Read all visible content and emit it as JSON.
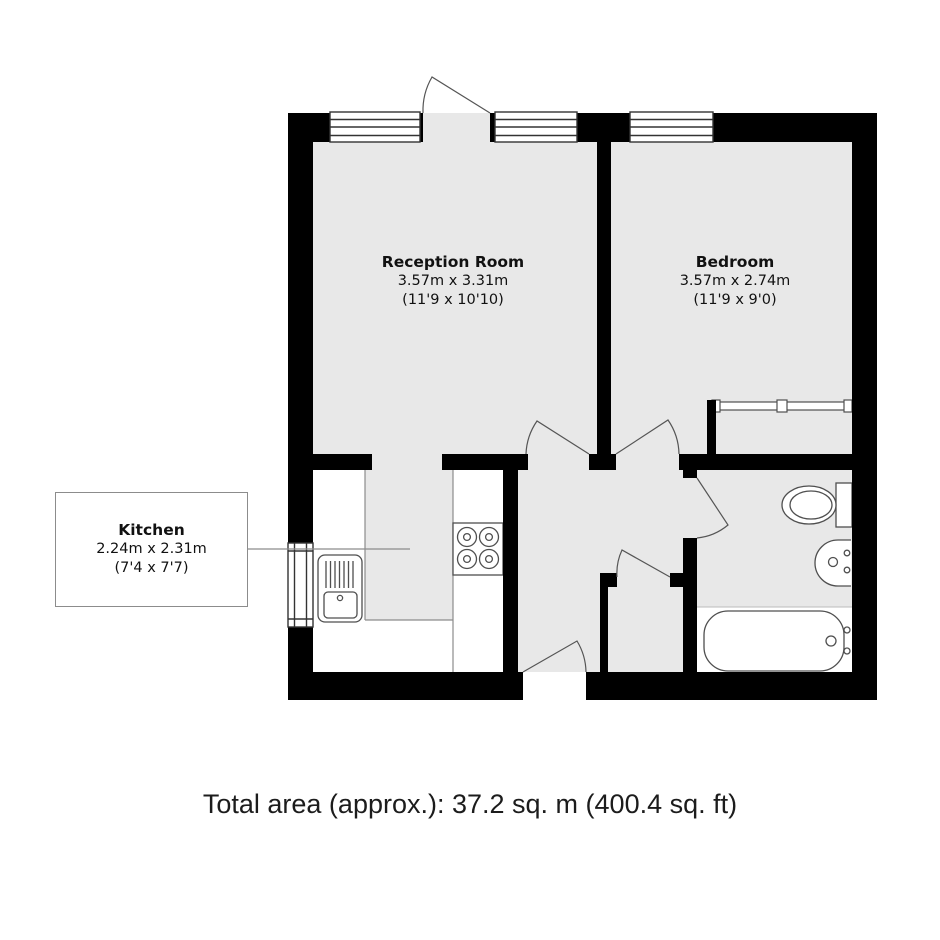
{
  "rooms": {
    "reception": {
      "name": "Reception Room",
      "metric": "3.57m x 3.31m",
      "imperial": "(11'9 x 10'10)"
    },
    "bedroom": {
      "name": "Bedroom",
      "metric": "3.57m x 2.74m",
      "imperial": "(11'9 x 9'0)"
    },
    "kitchen": {
      "name": "Kitchen",
      "metric": "2.24m x 2.31m",
      "imperial": "(7'4 x 7'7)"
    }
  },
  "footer": {
    "total_area": "Total area (approx.): 37.2 sq. m (400.4 sq. ft)"
  },
  "colors": {
    "wall": "#000000",
    "floor": "#e8e8e8",
    "fixture_line": "#4f4f4f",
    "counter_line": "#8c8c8c",
    "text": "#111111"
  }
}
